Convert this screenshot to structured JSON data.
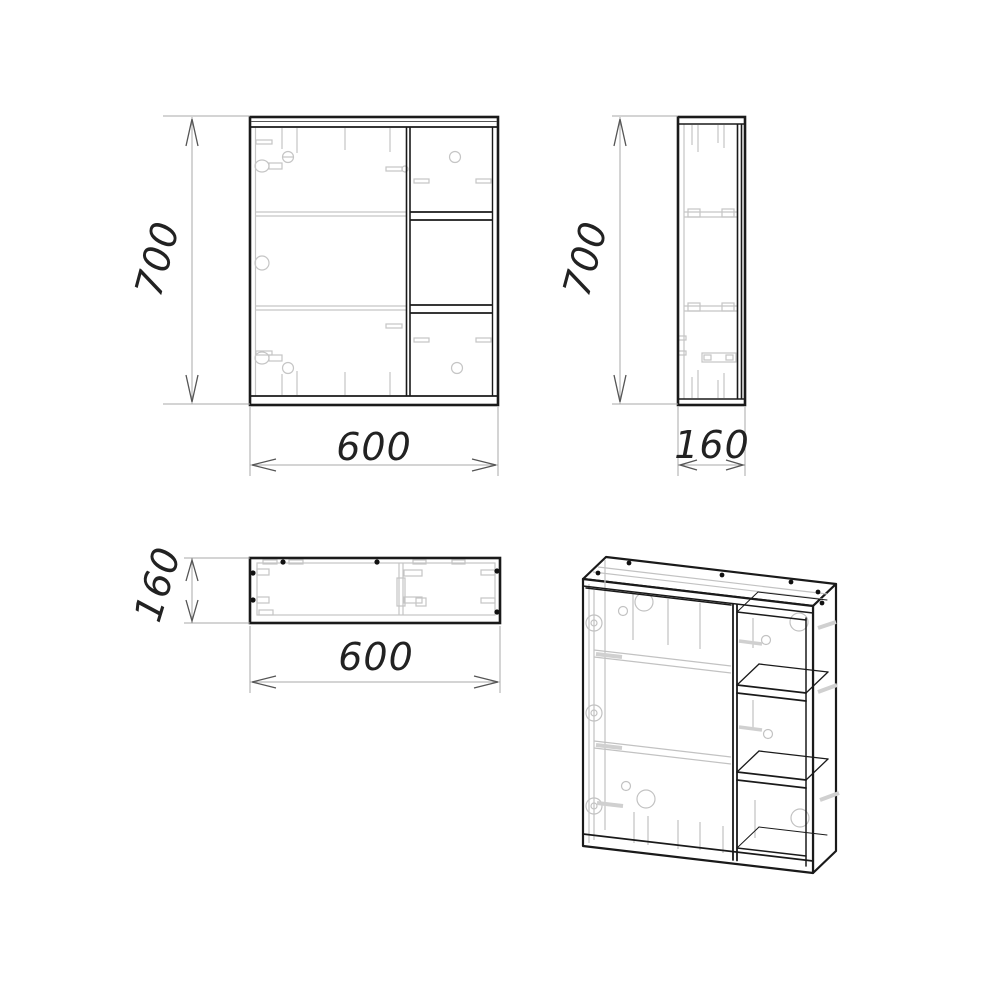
{
  "drawing": {
    "type": "technical-drawing",
    "subject": "wall-mounted mirror cabinet with open side shelves",
    "colors": {
      "background": "#ffffff",
      "outline": "#1a1a1a",
      "detail": "#c5c5c5",
      "dimension_line": "#a8a8a8",
      "arrow": "#555555",
      "text": "#222222"
    },
    "views": {
      "front": {
        "title": "front view",
        "height_mm": "700",
        "width_mm": "600"
      },
      "side": {
        "title": "side view",
        "height_mm": "700",
        "depth_mm": "160"
      },
      "bottom": {
        "title": "bottom view",
        "depth_mm": "160",
        "width_mm": "600"
      },
      "isometric": {
        "title": "isometric view"
      }
    }
  }
}
